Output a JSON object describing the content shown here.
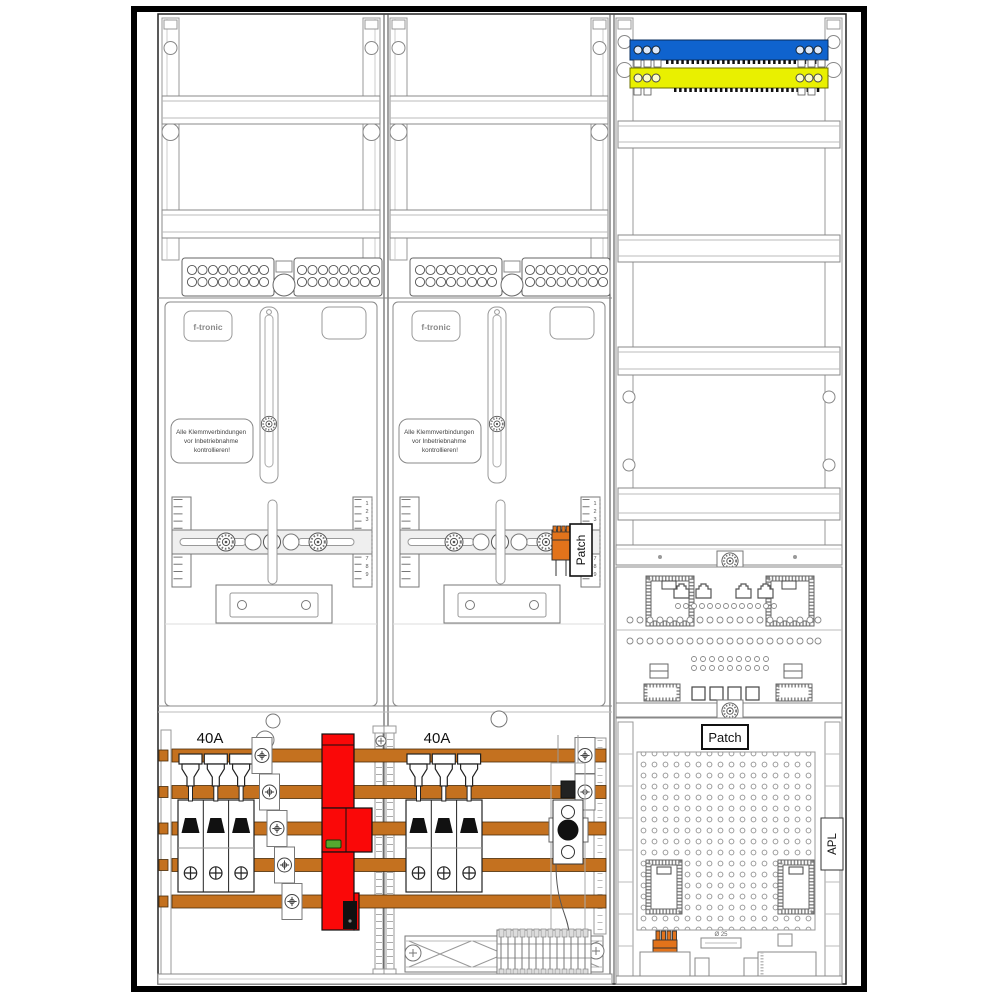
{
  "drawing": {
    "meter_fields": {
      "brand": "f-tronic",
      "warning_lines": [
        "Alle Klemmverbindungen",
        "vor Inbetriebnahme",
        "kontrollieren!"
      ]
    },
    "distribution": {
      "breaker_rating": "40A",
      "patch_label": "Patch",
      "apl_label": "APL",
      "knockout_note": "Ø 25"
    },
    "meter_cross_ruler_numbers": [
      "1",
      "2",
      "3",
      "7",
      "8",
      "9"
    ],
    "colors": {
      "busbar_copper": "#C4711F",
      "spd_red": "#FA0808",
      "led_green": "#55A82F",
      "neutral_blue": "#0F63CE",
      "pe_yellow": "#E9F000",
      "component_orange": "#E2731B"
    }
  }
}
